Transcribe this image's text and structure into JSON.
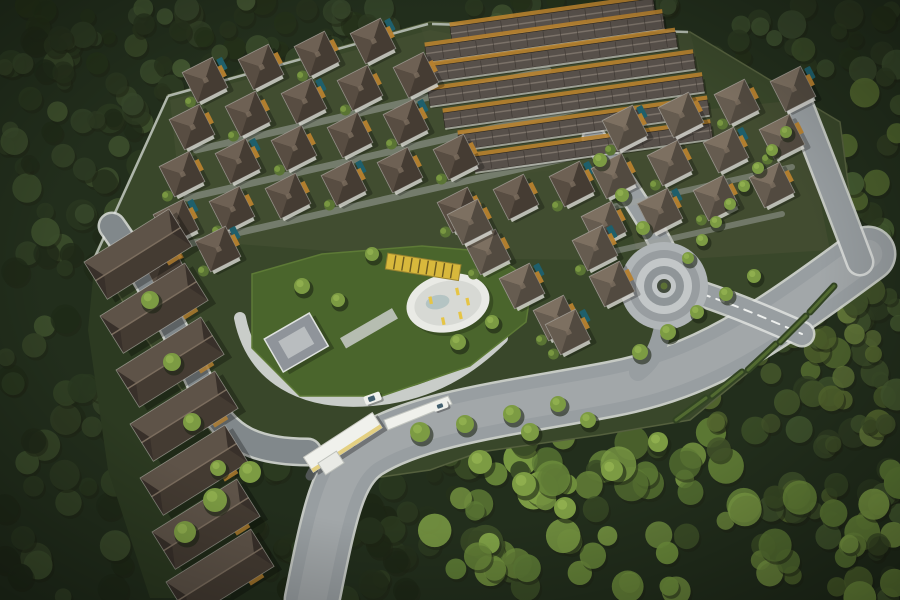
{
  "meta": {
    "title": "Aerial master plan render",
    "description": "Aerial 3D rendering of a forested residential estate: diagonal rows of dark-roofed villas, long townhouse rows at top, a column of row houses on the left, a central amenity lawn with an oval pool deck and yellow loungers, a roundabout, curved gray roads, and a white entrance gate at bottom center, all surrounded by dense green trees."
  },
  "palette": {
    "canvas": "#222e1c",
    "dev_ground": "#39472a",
    "road": "#989ea1",
    "road_sheen": "#abb0b2",
    "road_cobble": "#81888b",
    "curb": "#dfe2df",
    "dash": "#eef0ee",
    "lawn": "#4a652c",
    "lawn_edge": "#5d7a36",
    "pool_deck": "#e9eae5",
    "pool_inner": "#d7d9d4",
    "pool_water": "#aebfbf",
    "lounger": "#e6c544",
    "pergola": "#d8b83c",
    "pergola_stripe": "#6b5a20",
    "white": "#f0f1ec",
    "cream": "#e2cc76",
    "accent_orange": "#b8822f",
    "villa_pool": "#1f5f6b",
    "tree_dark": "#1d2414",
    "tree_mid": "#5a7434",
    "tree_light": "#7c9b43",
    "tree_hi": "#93b250",
    "hedge": "#324423",
    "roof_edge": "#2b2620",
    "eave": "#e6e6e0",
    "wall_white": "#dcdcd6",
    "booth_dark": "#595d5f",
    "car_window": "#44606f",
    "townroof": "#57504a",
    "townroof_hi": "#7b7269",
    "townroof_sep": "#3c3631",
    "villa_dark_base": "#453c33",
    "villa_dark_top": "#6e6154",
    "villa_dark_left": "#584d42",
    "villa_light_base": "#524a40",
    "villa_light_top": "#7d7061",
    "villa_light_left": "#665c50",
    "row_top": "#5e5348",
    "row_bottom": "#443b32",
    "row_end": "#38302a",
    "row_ridge": "#7b6d5e",
    "wall_line": "#c8cec8",
    "grid_path": "#9fa49f",
    "amen_path": "#c9cdc9",
    "clubhouse": "#8f949a",
    "clubhouse_in": "#b9bdbf",
    "rab_a": "#b0b5b7",
    "rab_b": "#989da0",
    "rab_c": "#c3c7c8",
    "rab_d": "#8f9598",
    "rab_center": "#434c3e",
    "rab_shrub": "#5c7035"
  },
  "scene": {
    "boundary": "168,95 430,22 690,32 840,122 858,258 800,330 690,420 600,435 480,452 430,470 360,480 300,445 225,452 140,330 95,255",
    "left_strip": "95,257 160,330 230,452 248,540 230,598 150,598 108,470 88,330",
    "tints": [
      {
        "pts": "170,100 430,30 640,70 600,260 420,258 185,240",
        "fill": "#4b5438",
        "op": 0.45
      },
      {
        "pts": "600,120 800,100 830,250 640,262",
        "fill": "#4f5639",
        "op": 0.4
      },
      {
        "pts": "420,25 690,32 720,150 470,180",
        "fill": "#474f35",
        "op": 0.4
      }
    ],
    "walls": [
      "M168,96 L428,24",
      "M95,257 L168,96",
      "M432,24 L688,32"
    ],
    "forest_regions": [
      {
        "x": 0,
        "y": 0,
        "w": 900,
        "h": 75,
        "n": 80,
        "rmin": 7,
        "rmax": 15,
        "shades": [
          "#2c3a21",
          "#35452a",
          "#3f5230",
          "#243119"
        ]
      },
      {
        "x": 0,
        "y": 40,
        "w": 180,
        "h": 560,
        "n": 90,
        "rmin": 8,
        "rmax": 16,
        "shades": [
          "#2a3820",
          "#334226",
          "#1f2a18",
          "#3c4e2c"
        ]
      },
      {
        "x": 60,
        "y": 0,
        "w": 360,
        "h": 230,
        "n": 100,
        "rmin": 7,
        "rmax": 14,
        "shades": [
          "#2c3a22",
          "#36462a",
          "#27331d",
          "#415430"
        ]
      },
      {
        "x": 770,
        "y": 30,
        "w": 130,
        "h": 570,
        "n": 80,
        "rmin": 8,
        "rmax": 16,
        "shades": [
          "#3c4e2a",
          "#465c31",
          "#2e3c22",
          "#52682f"
        ]
      },
      {
        "x": 180,
        "y": 430,
        "w": 300,
        "h": 170,
        "n": 60,
        "rmin": 8,
        "rmax": 15,
        "shades": [
          "#24301b",
          "#2d3c21",
          "#1d2715"
        ]
      },
      {
        "x": 430,
        "y": 430,
        "w": 470,
        "h": 170,
        "n": 85,
        "rmin": 9,
        "rmax": 18,
        "shades": [
          "#5d7a35",
          "#6f8f3d",
          "#7fa046",
          "#3a4c26"
        ]
      },
      {
        "x": 700,
        "y": 290,
        "w": 200,
        "h": 160,
        "n": 40,
        "rmin": 8,
        "rmax": 14,
        "shades": [
          "#55682f",
          "#64793a",
          "#42532a"
        ]
      }
    ],
    "roads": [
      {
        "name": "main-entry-road",
        "d": "M312,600 C330,510 338,472 366,452 C420,417 520,407 612,389 C705,371 762,332 868,254",
        "w": 52,
        "color": "road",
        "curb": true,
        "sheen": true
      },
      {
        "name": "right-perimeter-road",
        "d": "M797,98 C818,152 840,208 860,262",
        "w": 24,
        "color": "road",
        "curb": true
      },
      {
        "name": "roundabout-north-road",
        "d": "M594,138 C620,178 646,214 664,250",
        "w": 20,
        "color": "road",
        "curb": true
      },
      {
        "name": "roundabout-south-link",
        "d": "M664,322 C660,346 652,362 638,372",
        "w": 18,
        "color": "road"
      },
      {
        "name": "roundabout-east-road",
        "d": "M702,294 C738,306 770,320 802,334",
        "w": 22,
        "color": "road",
        "curb": true,
        "dashed": true
      },
      {
        "name": "west-cobble-road",
        "d": "M112,226 C152,282 182,342 206,396 C226,440 258,452 308,452",
        "w": 24,
        "color": "road_cobble",
        "curb": true
      },
      {
        "name": "amenity-loop-path",
        "d": "M240,318 C252,378 302,406 372,400 C432,395 472,368 502,338",
        "w": 12,
        "color": "amen_path"
      },
      {
        "name": "amenity-walk",
        "d": "M262,300 C320,286 372,276 420,270",
        "w": 8,
        "color": "amen_path"
      },
      {
        "name": "grid-lane-1",
        "d": "M196,150 L548,70",
        "w": 7,
        "color": "grid_path",
        "op": 0.55
      },
      {
        "name": "grid-lane-2",
        "d": "M187,198 L585,107",
        "w": 7,
        "color": "grid_path",
        "op": 0.55
      },
      {
        "name": "grid-lane-3",
        "d": "M180,246 L602,150",
        "w": 7,
        "color": "grid_path",
        "op": 0.55
      },
      {
        "name": "east-lane-1",
        "d": "M612,207 L792,167",
        "w": 6,
        "color": "grid_path",
        "op": 0.5
      },
      {
        "name": "east-lane-2",
        "d": "M602,254 L782,214",
        "w": 6,
        "color": "grid_path",
        "op": 0.5
      }
    ],
    "hedges": [
      "M706,398 L676,420",
      "M742,372 L712,396",
      "M776,344 L748,370",
      "M806,316 L780,342",
      "M834,286 L810,312"
    ],
    "roundabout": {
      "cx": 664,
      "cy": 286,
      "rings": [
        [
          44,
          "rab_a"
        ],
        [
          36,
          "rab_b"
        ],
        [
          28,
          "rab_c"
        ],
        [
          20,
          "rab_d"
        ],
        [
          12,
          "rab_c"
        ],
        [
          7,
          "rab_center"
        ],
        [
          3.5,
          "rab_shrub"
        ]
      ]
    },
    "amenity": {
      "lawn": "252,274 322,254 422,246 492,252 532,282 526,322 470,366 382,396 300,396 252,348",
      "pool": {
        "cx": 448,
        "cy": 303,
        "rx": 42,
        "ry": 29,
        "rot": -12
      },
      "loungers": [
        [
          458,
          290
        ],
        [
          466,
          302
        ],
        [
          456,
          314
        ],
        [
          438,
          316
        ],
        [
          430,
          293
        ]
      ],
      "pergola": {
        "x": 386,
        "y": 259,
        "w": 74,
        "h": 16,
        "rot": 9,
        "cx": 424,
        "cy": 268
      },
      "clubhouse": {
        "x": 272,
        "y": 322,
        "w": 52,
        "h": 38,
        "rot": -30,
        "cx": 300,
        "cy": 345
      },
      "trellis": {
        "x": 340,
        "y": 322,
        "w": 60,
        "h": 12,
        "rot": -30,
        "cx": 370,
        "cy": 330
      }
    },
    "townhouse_rot": -8,
    "townhouse_h": 15,
    "townhouses": [
      {
        "x": 450,
        "y": 27,
        "len": 205
      },
      {
        "x": 425,
        "y": 47,
        "len": 240
      },
      {
        "x": 413,
        "y": 69,
        "len": 265
      },
      {
        "x": 428,
        "y": 91,
        "len": 268
      },
      {
        "x": 443,
        "y": 113,
        "len": 262
      },
      {
        "x": 458,
        "y": 135,
        "len": 252
      },
      {
        "x": 473,
        "y": 157,
        "len": 240
      }
    ],
    "villa": {
      "dx": 56,
      "dy": -13,
      "size": 34,
      "rot": -27
    },
    "villa_rows": [
      {
        "x": 205,
        "y": 80,
        "n": 4,
        "tone": "dark"
      },
      {
        "x": 192,
        "y": 127,
        "n": 5,
        "tone": "dark"
      },
      {
        "x": 182,
        "y": 174,
        "n": 5,
        "tone": "dark"
      },
      {
        "x": 176,
        "y": 222,
        "n": 6,
        "tone": "dark"
      },
      {
        "x": 460,
        "y": 210,
        "n": 3,
        "tone": "dark"
      },
      {
        "x": 162,
        "y": 262,
        "n": 2,
        "tone": "dark"
      },
      {
        "x": 625,
        "y": 128,
        "n": 4,
        "tone": "light"
      },
      {
        "x": 614,
        "y": 176,
        "n": 4,
        "tone": "light"
      },
      {
        "x": 604,
        "y": 224,
        "n": 4,
        "tone": "light"
      }
    ],
    "villa_extra": [
      [
        595,
        248
      ],
      [
        612,
        284
      ],
      [
        488,
        252
      ],
      [
        522,
        286
      ],
      [
        556,
        318
      ],
      [
        470,
        222
      ],
      [
        568,
        332
      ]
    ],
    "rowhouse": {
      "w": 100,
      "h": 44,
      "rot": -32
    },
    "rowhouses": [
      [
        84,
        262
      ],
      [
        100,
        316
      ],
      [
        116,
        370
      ],
      [
        130,
        424
      ],
      [
        140,
        478
      ],
      [
        152,
        532
      ],
      [
        166,
        582
      ]
    ],
    "entrance": {
      "arm": "388,430 452,404 448,396 384,420",
      "canopy": {
        "x": 302,
        "y": 434,
        "w": 82,
        "h": 18,
        "rot": -33,
        "cx": 342,
        "cy": 443
      },
      "booth": {
        "x": 320,
        "y": 456,
        "w": 22,
        "h": 14,
        "rot": -33,
        "cx": 331,
        "cy": 463
      },
      "loop": "M310,476 C320,455 335,447 352,443"
    },
    "cars": [
      {
        "x": 364,
        "y": 394,
        "w": 17,
        "h": 9,
        "rot": -20,
        "cx": 372,
        "cy": 398
      },
      {
        "x": 433,
        "y": 402,
        "w": 15,
        "h": 8,
        "rot": -20,
        "cx": 440,
        "cy": 406
      }
    ],
    "trees": [
      [
        420,
        432,
        10
      ],
      [
        465,
        424,
        9
      ],
      [
        512,
        414,
        9
      ],
      [
        558,
        404,
        8
      ],
      [
        640,
        352,
        8
      ],
      [
        668,
        332,
        8
      ],
      [
        697,
        312,
        7
      ],
      [
        726,
        294,
        7
      ],
      [
        754,
        276,
        7
      ],
      [
        688,
        258,
        6
      ],
      [
        702,
        240,
        6
      ],
      [
        716,
        222,
        6
      ],
      [
        730,
        204,
        6
      ],
      [
        744,
        186,
        6
      ],
      [
        758,
        168,
        6
      ],
      [
        772,
        150,
        6
      ],
      [
        786,
        132,
        6
      ],
      [
        250,
        472,
        11
      ],
      [
        215,
        500,
        12
      ],
      [
        185,
        532,
        11
      ],
      [
        302,
        286,
        8
      ],
      [
        338,
        300,
        7
      ],
      [
        458,
        342,
        8
      ],
      [
        492,
        322,
        7
      ],
      [
        372,
        254,
        7
      ],
      [
        480,
        462,
        12
      ],
      [
        524,
        484,
        12
      ],
      [
        565,
        508,
        11
      ],
      [
        612,
        470,
        11
      ],
      [
        658,
        442,
        10
      ],
      [
        150,
        300,
        9
      ],
      [
        172,
        362,
        9
      ],
      [
        192,
        422,
        9
      ],
      [
        218,
        468,
        8
      ],
      [
        600,
        160,
        7
      ],
      [
        622,
        195,
        7
      ],
      [
        643,
        228,
        7
      ],
      [
        530,
        432,
        9
      ],
      [
        588,
        420,
        8
      ]
    ]
  }
}
